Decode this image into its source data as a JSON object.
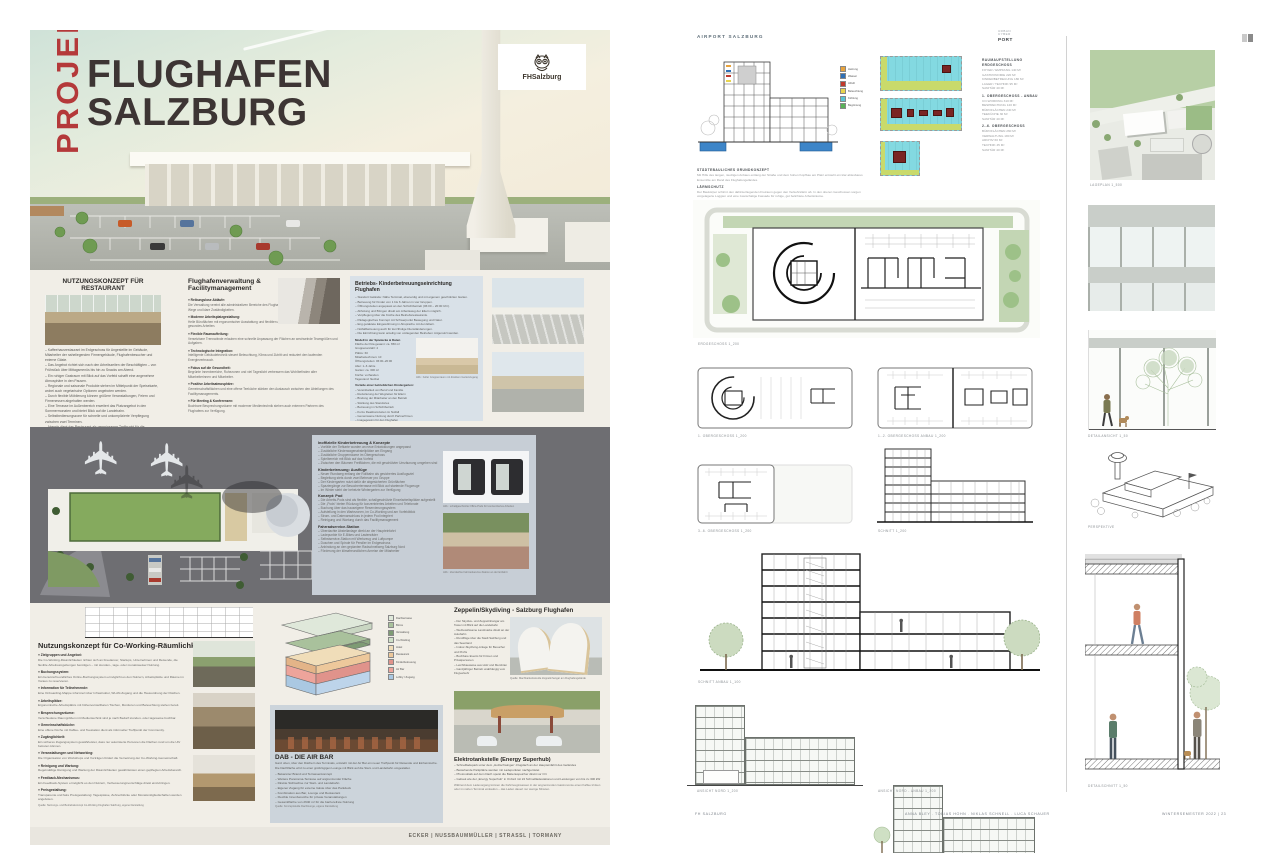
{
  "colors": {
    "accent_red": "#b4393a",
    "title_dark": "#3d3534",
    "cream_bg": "#f1eee7",
    "panel_blue": "#d9e1e8",
    "panel_gray_blue": "#c7ced6",
    "site_gray": "#6e6e72",
    "teal_diagram": "#83d9e1",
    "diagram_red": "#7a2523",
    "plan_green": "#b7cfa5"
  },
  "left": {
    "hero": {
      "vertical": "PROJEKT",
      "line1": "FLUGHAFEN",
      "line2": "SALZBURG",
      "logo": "FHSalzburg"
    },
    "restaurant": {
      "heading": "NUTZUNGSKONZEPT FÜR RESTAURANT",
      "body": "– Kaffeehausrestaurant im Erdgeschoss für Angestellte im Gebäude, Mitarbeiter der naheliegenden Firmengebäude, Flughafenbesucher und externe Gäste.\n– Das Angebot richtet sich nach den Arbeitszeiten der Beschäftigten – von Frühstück über Mittagsmenüs bis hin zu Snacks am Abend.\n– Ein ruhiger Gastraum mit Blick auf das Vorfeld schafft eine angenehme Atmosphäre in den Pausen.\n– Regionale und saisonale Produkte stehen im Mittelpunkt der Speisekarte, wobei auch vegetarische Optionen angeboten werden.\n– Durch flexible Möblierung können größere Veranstaltungen, Feiern und Firmenessen abgehalten werden.\n– Eine Terrasse im Außenbereich erweitert das Platzangebot in den Sommermonaten und bietet Blick auf die Landebahn.\n– Selbstbedienungszone für schnelle und unkomplizierte Verpflegung zwischen zwei Terminen.\n– Abends dient das Restaurant als gemeinsamer Treffpunkt für die Mitarbeiter des Flughafens und der Umgebung."
    },
    "facility": {
      "heading": "Flughafenverwaltung & Facilitymanagement",
      "blocks": [
        {
          "h": "» Reibungslose Abläufe:",
          "t": "Die Verwaltung vereint alle administrativen Bereiche des Flughafens unter einem Dach und sorgt für kurze Wege und klare Zuständigkeiten."
        },
        {
          "h": "» Moderne Arbeitsplatzgestaltung:",
          "t": "Helle Büroflächen mit ergonomischer Ausstattung und flexiblen Arbeitsplätzen fördern konzentriertes und gesundes Arbeiten."
        },
        {
          "h": "» Flexible Raumaufteilung:",
          "t": "Versetzbare Trennwände erlauben eine schnelle Anpassung der Flächen an wechselnde Teamgrößen und Aufgaben."
        },
        {
          "h": "» Technologische Integration:",
          "t": "Intelligente Gebäudetechnik steuert Beleuchtung, Klima und Zutritt und reduziert den laufenden Energieverbrauch."
        },
        {
          "h": "» Fokus auf die Gesundheit:",
          "t": "Begrünte Innenbereiche, Ruhezonen und viel Tageslicht verbessern das Wohlbefinden aller Mitarbeiterinnen und Mitarbeiter."
        },
        {
          "h": "» Positive Arbeitsatmosphäre:",
          "t": "Gemeinschaftsflächen und eine offene Teeküche stärken den Austausch zwischen den Abteilungen des Facilitymanagements."
        },
        {
          "h": "» Für Meeting & Konferenzen:",
          "t": "Buchbare Besprechungsräume mit moderner Medientechnik stehen auch externen Partnern des Flughafens zur Verfügung."
        }
      ]
    },
    "kinder": {
      "heading": "Betriebs- Kinderbetreuungseinrichtung Flughafen",
      "bullets": "– Standort Gelände: Nähe Terminal, ebenerdig und mit eigenem geschützten Garten.\n– Betreuung für Kinder von 1 bis 6 Jahren in vier Gruppen.\n– Öffnungszeiten angepasst an den Schichtbetrieb (06:00 – 20:00 Uhr).\n– Abholung und Bringen direkt am Arbeitsweg der Eltern möglich.\n– Verpflegung über die Küche des Betriebsrestaurants.\n– Pädagogisches Konzept mit Schwerpunkt Bewegung und Natur.\n– Eng getaktete Eingewöhnung in Absprache mit den Eltern.\n– Notfallbetreuung auch für kurzfristige Dienständerungen.\n– Die Einrichtung kann anteilig von umliegenden Betrieben mitgenutzt werden.",
      "data_heading": "Modell in der Spielecke & Daten",
      "table": "Fläche der Kita gesamt: ca. 650 m²\nGruppenanzahl: 4\nPlätze: 60\nMitarbeiter/innen: 10\nÖffnungszeiten: 06:00–20:00\nAlter: 1–6 Jahre\nGarten: ca. 300 m²\nKüche: vorhanden\nTagesrand: flexibel",
      "photo_caption": "Abb.: heller Gruppenraum mit direktem Gartenzugang",
      "vorteile_heading": "Vorteile einer betrieblichen Kindergarten:",
      "vorteile": "– Vereinbarkeit von Beruf und Familie\n– Reduzierung der Wegzeiten für Eltern\n– Bindung der Mitarbeiter an den Betrieb\n– Stärkung des Standortes\n– Betreuung im Schichtbetrieb\n– Kurze Reaktionszeiten im Notfall\n– Gemeinsame Nutzung durch Partnerfirmen\n– Imagegewinn für den Flughafen"
    },
    "siteplan_panel": {
      "groups": [
        {
          "h": "Inoffizielle Kinderbetreuung & Konzepte",
          "t": "– Vorfälle der Tiefkarte wurden an neue Entwicklungen angepasst\n– Zusätzliche Kinderwagenabstellplätze am Eingang\n– Zusätzliche Gruppenräume im Obergeschoss\n– Spielbereich mit Blick auf das Vorfeld\n– Zwischen den Bäumen Freiflächen, die mit geschützter Umzäunung umgeben sind"
        },
        {
          "h": "Kinderbetreuung: Ausflüge",
          "t": "– Neuer Rundweg entlang der Rollbahn als gesichertes Ausflugsziel\n– Begleitung stets durch zwei Betreuer pro Gruppe\n– Der Kindergarten nutzt dafür die abgesicherten Grünflächen\n– Spaziergänge zur Besucherterrasse mit Blick auf startende Flugzeuge\n– Im Winter steht der beheizte Wintergarten zur Verfügung"
        },
        {
          "h": "Konzept: Pod",
          "t": "– Die Arbeits-Pods sind als flexible, schallgeschützte Einzelarbeitsplätze aufgestellt\n– Die „Pods“ bieten Rückzug für konzentriertes Arbeiten und Telefonate\n– Buchung über das hauseigene Reservierungssystem\n– Aufstellung in den Wartezonen, im Co-Working und am Vorfeldblick\n– Strom- und Datenanschluss in jedem Pod integriert\n– Reinigung und Wartung durch das Facilitymanagement"
        },
        {
          "h": "Fahrradservice-Station",
          "t": "– Überdachte Abstellanlage direkt an der Haupteinfahrt\n– Ladepunkte für E-Bikes und Lastenräder\n– Selbstservice-Station mit Werkzeug und Luftpumpe\n– Duschen und Spinde für Pendler im Erdgeschoss\n– Anbindung an den geplanten Radschnellweg Salzburg Nord\n– Förderung der klimafreundlichen Anreise der Mitarbeiter"
        }
      ],
      "pods_caption": "Abb.: schallgeschützte Office-Pods für konzentriertes Arbeiten",
      "shelter_caption": "Abb.: überdachte Fahrradservice-Station an der Einfahrt"
    },
    "coworking": {
      "heading": "Nutzungskonzept für Co-Working-Räumlichkeiten",
      "blocks": [
        {
          "h": "» Zielgruppen und Angebot:",
          "t": "Die Co-Working-Räumlichkeiten richten sich an Freelancer, Startups, Unternehmen und Reisende, die flexible Arbeitsumgebungen benötigen – mit stunden-, tage- oder monatsweiser Nutzung."
        },
        {
          "h": "» Buchungssystem:",
          "t": "Ein benutzerfreundliches Online-Buchungssystem ermöglicht es den Nutzern, Arbeitsplätze und Räume im Voraus zu reservieren."
        },
        {
          "h": "» Information für Teilnehmende:",
          "t": "Eine Onboarding-Mappe informiert über Infrastruktur, WLAN-Zugang und die Hausordnung der Flächen."
        },
        {
          "h": "» Arbeitsplätze:",
          "t": "Ergonomische Arbeitsplätze mit höhenverstellbaren Tischen, Monitoren und Beleuchtung stehen bereit."
        },
        {
          "h": "» Besprechungsräume:",
          "t": "Verschiedene Raumgrößen mit Medientechnik sind je nach Bedarf stunden- oder tageweise buchbar."
        },
        {
          "h": "» Gemeinschaftsküche:",
          "t": "Eine offene Küche mit Kaffee- und Teestation dient als informeller Treffpunkt der Community."
        },
        {
          "h": "» Zugänglichkeit:",
          "t": "Ein sicheres Zugangssystem gewährleistet, dass nur autorisierte Personen die Flächen rund um die Uhr betreten können."
        },
        {
          "h": "» Veranstaltungen und Networking:",
          "t": "Die Organisation von Workshops und Vorträgen fördert die Vernetzung der Co-Working-Gemeinschaft."
        },
        {
          "h": "» Reinigung und Wartung:",
          "t": "Regelmäßige Reinigung und Wartung der Räumlichkeiten gewährleisten einen gepflegten Arbeitsbereich."
        },
        {
          "h": "» Feedback-Mechanismus:",
          "t": "Ein Feedback-System ermöglicht es den Nutzern, Verbesserungsvorschläge direkt einzubringen."
        },
        {
          "h": "» Preisgestaltung:",
          "t": "Transparente und faire Preisgestaltung: Tagespässe, Zehnerblöcke oder Monatsmitgliedschaften werden angeboten."
        }
      ],
      "source_note": "Quelle: Nutzungs- und Betriebskonzept Co-Working Flughafen Salzburg, eigene Darstellung"
    },
    "axon": {
      "legend": [
        {
          "c": "#dfe8da",
          "l": "Dachterrasse"
        },
        {
          "c": "#a9c19c",
          "l": "Büros"
        },
        {
          "c": "#7e9b74",
          "l": "Verwaltung"
        },
        {
          "c": "#cfe0c8",
          "l": "Co-Working"
        },
        {
          "c": "#f0ddb9",
          "l": "Hotel"
        },
        {
          "c": "#edc89b",
          "l": "Restaurant"
        },
        {
          "c": "#e0938b",
          "l": "Kinderbetreuung"
        },
        {
          "c": "#eda49b",
          "l": "Air Bar"
        },
        {
          "c": "#aac8e2",
          "l": "Lobby / Zugang"
        }
      ]
    },
    "airbar": {
      "heading": "DAB - DIE AIR BAR",
      "para": "Ganz oben, über den Dächern des Terminals, entsteht mit der Air Bar ein neuer Treffpunkt für Reisende und Einheimische. Die Dachfläche wird zu einer großzügigen Lounge mit Blick auf die Start- und Landebahn umgestaltet.",
      "bullets": "– Bekannter Brand und Terrassenkonzept\n– Weitere Panorama-Terrasse auf angrenzender Fläche\n– Direkte Sichtachse zur Start- und Landebahn\n– Eigener Zugang für externe Gäste über das Parkdeck\n– Kombination aus Bar, Lounge und Restaurant\n– Flexible Innenbereiche für private Veranstaltungen\n– Gesamtfläche von 2640 m² für die barrierefreie Nutzung",
      "note": "Quelle: Konzeptstudie Dachlounge, eigene Darstellung"
    },
    "zeppelin": {
      "heading": "Zeppelin/Skydiving - Salzburg Flughafen",
      "bullets": "– Der Skydive- und Zeppelinhangar am Tower mit Blick auf die Landebahn\n– Werbewirksame Landmarke direkt an der Autobahn\n– Rundflüge über die Stadt Salzburg und das Seenland\n– Indoor-Skydiving-Anlage für Besucher und Profis\n– Buchbare Events für Firmen und Privatpersonen\n– Leichtbauweise aus Holz und Membran\n– Ganzjähriger Betrieb unabhängig vom Flugverkehr",
      "caption": "Quelle: Machbarkeitsstudie Zeppelinhangar am Flughafengelände"
    },
    "etank": {
      "heading": "Elektrotankstelle (Energy Superhub)",
      "bullets": "– Schnellladepark unter dem „Holzschwingen“-Flugdach an der Haupteinfahrt des Geländes\n– Bestehende Parkplätze werden mit Ladepunkten nachgerüstet\n– Photovoltaik auf dem Dach speist die Batteriespeicher direkt vor Ort\n– Gebaut wie der „Energy Superhub“ in Oxford mit 24 Schnellladestationen und Leistungen von bis zu 300 kW",
      "para": "Während dem Ladevorgang können die Fahrzeuginsassen in der angrenzenden Gastronomie einen Kaffee trinken oder im nahen Terminal einkaufen – das Laden dauert nur wenige Minuten."
    },
    "footer": "ECKER | NUSSBAUMMÜLLER | STRASSL | TORMANY"
  },
  "right": {
    "title": "AIRPORT SALZBURG",
    "logo": {
      "l1": "URBAN",
      "l2": "CYBER",
      "l3": "PORT"
    },
    "legend": [
      {
        "c": "#e8a33d",
        "l": "Heizung"
      },
      {
        "c": "#2e6fb5",
        "l": "Wasser"
      },
      {
        "c": "#c0392b",
        "l": "Abluft"
      },
      {
        "c": "#e8d44d",
        "l": "Beleuchtung"
      },
      {
        "c": "#58c5d4",
        "l": "Kühlung"
      },
      {
        "c": "#58b157",
        "l": "Begrünung"
      }
    ],
    "concept_blocks": [
      {
        "h": "STÄDTEBAULICHES GRUNDKONZEPT",
        "t": "Mit Hilfe des langen, niedrigen Anbaus entlang der Straße und dem hohen Kopfbau am Platz entsteht ein klar ablesbares Ensemble am Rand des Flughafengeländes."
      },
      {
        "h": "LÄRMSCHUTZ",
        "t": "Der Baukörper schirmt den dahinterliegenden Freiraum gegen den Verkehrslärm ab. In den oberen Geschossen sorgen vorgelagerte Loggien und eine zweischalige Fassade für ruhige, gut belichtete Arbeitsräume."
      },
      {
        "h": "NUTZUNGSVERTEILUNG",
        "t": "Im Erdgeschoss liegen die öffentlichen Nutzungen, darüber stapeln sich Co-Working, Büros und Verwaltung bis zur Dachterrasse mit Blick auf die Landebahn."
      }
    ],
    "konzept_label": "KONZEPT",
    "room_program": {
      "heading": "RAUMAUFSTELLUNG",
      "blocks": [
        {
          "h": "ERDGESCHOSS",
          "t": "FOYER / EMPFANG 140 M²\nGASTRONOMIE 220 M²\nKINDERBETREUUNG 180 M²\nLAGER / TECHNIK 95 M²\nSANITÄR 40 M²"
        },
        {
          "h": "1. OBERGESCHOSS - ANBAU",
          "t": "CO-WORKING 310 M²\nBESPRECHUNG 120 M²\nBÜROFLÄCHEN 240 M²\nTEEKÜCHE 30 M²\nSANITÄR 40 M²"
        },
        {
          "h": "2.-6. OBERGESCHOSS",
          "t": "BÜROFLÄCHEN 260 M²\nVERWALTUNG 180 M²\nARCHIV 60 M²\nTECHNIK 45 M²\nSANITÄR 40 M²"
        }
      ]
    },
    "captions": {
      "lageplan": "LAGEPLAN 1_500",
      "eg": "ERDGESCHOSS 1_200",
      "og1": "1. OBERGESCHOSS 1_200",
      "og12": "1.-2. OBERGESCHOSS ANBAU 1_200",
      "og36": "3.-6. OBERGESCHOSS 1_200",
      "schnitt": "SCHNITT 1_200",
      "schnitt_anbau": "SCHNITT ANBAU 1_100",
      "ansicht_nord": "ANSICHT NORD 1_200",
      "ansicht_nord_anbau": "ANSICHT NORD - ANBAU 1_200",
      "detailansicht": "DETAILANSICHT 1_50",
      "perspektive": "PERSPEKTIVE",
      "detailschnitt": "DETAILSCHNITT 1_50"
    },
    "footer": {
      "school": "FH SALZBURG",
      "names": "ANNA BLEY  .  TOBIAS HOHN  .  NIKLAS SCHNELL  .  LUCA SCHAUER",
      "semester": "WINTERSEMESTER 2022 | 23"
    }
  }
}
